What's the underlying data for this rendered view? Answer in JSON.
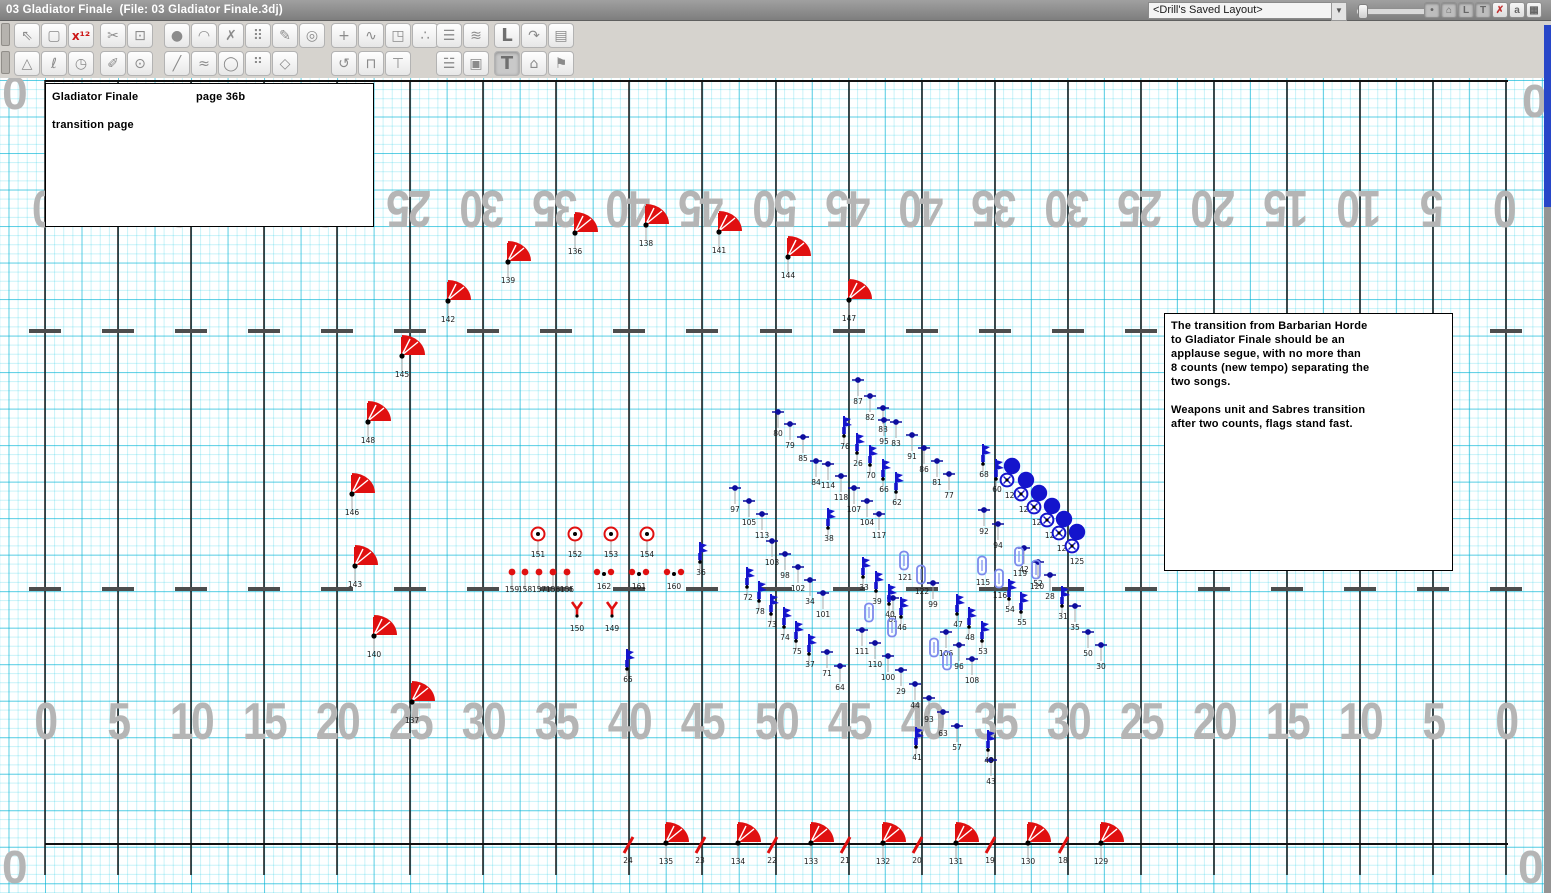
{
  "titlebar": {
    "title": "03 Gladiator Finale  (File: 03 Gladiator Finale.3dj)",
    "layout_selector": "<Drill's Saved Layout>",
    "dropdown_arrow": "▼"
  },
  "titlebar_buttons": [
    {
      "name": "dot-view-button",
      "glyph": "•",
      "pressed": true
    },
    {
      "name": "home-view-button",
      "glyph": "⌂",
      "pressed": true
    },
    {
      "name": "l-view-button",
      "glyph": "L",
      "pressed": true
    },
    {
      "name": "t-view-button",
      "glyph": "T",
      "pressed": true
    },
    {
      "name": "close-button",
      "glyph": "✗",
      "pressed": false,
      "red": true
    },
    {
      "name": "zoom-tool-button",
      "glyph": "a",
      "pressed": false
    },
    {
      "name": "grid-view-button",
      "glyph": "▦",
      "pressed": false
    }
  ],
  "toolbar": {
    "row1_groups": [
      {
        "left": 14,
        "buttons": [
          {
            "name": "select-tool",
            "glyph": "⇖"
          },
          {
            "name": "marquee-select-tool",
            "glyph": "▢"
          },
          {
            "name": "count-x12-tool",
            "glyph": "x¹²",
            "red": true
          }
        ]
      },
      {
        "left": 100,
        "buttons": [
          {
            "name": "cut-tool",
            "glyph": "✂"
          },
          {
            "name": "segment-node-tool",
            "glyph": "⊡"
          }
        ]
      },
      {
        "left": 164,
        "buttons": [
          {
            "name": "dot-tool",
            "glyph": "●"
          },
          {
            "name": "arc-tool",
            "glyph": "◠"
          },
          {
            "name": "curve-tool",
            "glyph": "✗"
          },
          {
            "name": "block-grid-tool",
            "glyph": "⠿"
          },
          {
            "name": "pencil-tool",
            "glyph": "✎"
          },
          {
            "name": "spiral-tool",
            "glyph": "◎"
          }
        ]
      },
      {
        "left": 331,
        "buttons": [
          {
            "name": "move-tool",
            "glyph": "+"
          },
          {
            "name": "path-adjust-tool",
            "glyph": "∿"
          },
          {
            "name": "scale-tool",
            "glyph": "◳"
          },
          {
            "name": "scatter-tool",
            "glyph": "∴"
          }
        ]
      },
      {
        "left": 436,
        "buttons": [
          {
            "name": "align-lines-tool",
            "glyph": "☰"
          },
          {
            "name": "ripple-tool",
            "glyph": "≋"
          }
        ]
      },
      {
        "left": 494,
        "buttons": [
          {
            "name": "ell-maneuver-tool",
            "glyph": "L",
            "big": true
          },
          {
            "name": "follow-arrow-tool",
            "glyph": "↷"
          },
          {
            "name": "notes-sheet-tool",
            "glyph": "▤"
          }
        ]
      }
    ],
    "row2_groups": [
      {
        "left": 14,
        "buttons": [
          {
            "name": "cone-tool",
            "glyph": "△"
          },
          {
            "name": "lasso-tool",
            "glyph": "ℓ"
          },
          {
            "name": "history-clock-tool",
            "glyph": "◷"
          }
        ]
      },
      {
        "left": 100,
        "buttons": [
          {
            "name": "highlighter-tool",
            "glyph": "✐"
          },
          {
            "name": "location-pin-tool",
            "glyph": "⊙"
          }
        ]
      },
      {
        "left": 164,
        "buttons": [
          {
            "name": "line-tool",
            "glyph": "╱"
          },
          {
            "name": "freeform-wave-tool",
            "glyph": "≈"
          },
          {
            "name": "circle-tool",
            "glyph": "◯"
          },
          {
            "name": "dot-cluster-tool",
            "glyph": "⠛"
          },
          {
            "name": "polygon-tool",
            "glyph": "◇"
          }
        ]
      },
      {
        "left": 331,
        "buttons": [
          {
            "name": "rotate-tool",
            "glyph": "↺"
          },
          {
            "name": "gate-turn-tool",
            "glyph": "⊓"
          },
          {
            "name": "pole-tool",
            "glyph": "⊤"
          }
        ]
      },
      {
        "left": 436,
        "buttons": [
          {
            "name": "distribute-tool",
            "glyph": "☱"
          },
          {
            "name": "duplicate-tool",
            "glyph": "▣"
          }
        ]
      },
      {
        "left": 494,
        "buttons": [
          {
            "name": "text-tool",
            "glyph": "T",
            "big": true,
            "pressed": true
          },
          {
            "name": "home-view-tool",
            "glyph": "⌂"
          },
          {
            "name": "flag-marker-tool",
            "glyph": "⚑"
          }
        ]
      }
    ]
  },
  "notes": {
    "box1": {
      "title": "Gladiator Finale",
      "page": "page 36b",
      "subtitle": "transition page"
    },
    "box2_text": "The transition from Barbarian Horde\nto Gladiator Finale should be an\napplause segue, with no more than\n8 counts (new tempo) separating the\ntwo songs.\n\nWeapons unit and Sabres transition\nafter two counts, flags stand fast."
  },
  "field": {
    "yard_numbers": [
      "0",
      "5",
      "10",
      "15",
      "20",
      "25",
      "30",
      "35",
      "40",
      "45",
      "50",
      "45",
      "40",
      "35",
      "30",
      "25",
      "20",
      "15",
      "10",
      "5",
      "0"
    ],
    "corner_zero": "0",
    "left_x": 45,
    "line_spacing": 73.05,
    "top_y": 80,
    "bottom_y": 843,
    "hash_rows": [
      329,
      587
    ],
    "colors": {
      "red": "#e01010",
      "blue": "#1414cc",
      "navy": "#0d0d9e",
      "light_blue": "#7d8aec",
      "number_gray": "#b5b5b5",
      "grid_cyan": "#9adfee",
      "stem_gray": "#a8a8a8"
    }
  },
  "performers": {
    "red_flags": [
      [
        575,
        233,
        "136"
      ],
      [
        646,
        225,
        "138"
      ],
      [
        719,
        232,
        "141"
      ],
      [
        788,
        257,
        "144"
      ],
      [
        849,
        300,
        "147"
      ],
      [
        508,
        262,
        "139"
      ],
      [
        448,
        301,
        "142"
      ],
      [
        402,
        356,
        "145"
      ],
      [
        368,
        422,
        "148"
      ],
      [
        352,
        494,
        "146"
      ],
      [
        355,
        566,
        "143"
      ],
      [
        374,
        636,
        "140"
      ],
      [
        412,
        702,
        "137"
      ],
      [
        666,
        843,
        "135"
      ],
      [
        738,
        843,
        "134"
      ],
      [
        811,
        843,
        "133"
      ],
      [
        883,
        843,
        "132"
      ],
      [
        956,
        843,
        "131"
      ],
      [
        1028,
        843,
        "130"
      ],
      [
        1101,
        843,
        "129"
      ]
    ],
    "red_slashes": [
      [
        628,
        845,
        "24"
      ],
      [
        700,
        845,
        "23"
      ],
      [
        772,
        845,
        "22"
      ],
      [
        845,
        845,
        "21"
      ],
      [
        917,
        845,
        "20"
      ],
      [
        990,
        845,
        "19"
      ],
      [
        1063,
        845,
        "18"
      ]
    ],
    "red_circle_dots": [
      [
        538,
        534,
        "151"
      ],
      [
        575,
        534,
        "152"
      ],
      [
        611,
        534,
        "153"
      ],
      [
        647,
        534,
        "154"
      ]
    ],
    "red_dots": [
      [
        512,
        572,
        "159"
      ],
      [
        525,
        572,
        "158"
      ],
      [
        539,
        572,
        "157"
      ],
      [
        553,
        572,
        "156"
      ],
      [
        567,
        572,
        "155"
      ]
    ],
    "red_tridots": [
      [
        604,
        571,
        "162"
      ],
      [
        639,
        571,
        "161"
      ],
      [
        674,
        571,
        "160"
      ]
    ],
    "red_ys": [
      [
        577,
        611,
        "150"
      ],
      [
        612,
        611,
        "149"
      ]
    ],
    "blue_dots": [
      [
        858,
        380,
        "87"
      ],
      [
        870,
        396,
        "82"
      ],
      [
        883,
        408,
        "88"
      ],
      [
        884,
        420,
        "95"
      ],
      [
        896,
        422,
        "83"
      ],
      [
        778,
        412,
        "80"
      ],
      [
        790,
        424,
        "79"
      ],
      [
        803,
        437,
        "85"
      ],
      [
        816,
        461,
        "84"
      ],
      [
        828,
        464,
        "114"
      ],
      [
        841,
        476,
        "118"
      ],
      [
        735,
        488,
        "97"
      ],
      [
        749,
        501,
        "105"
      ],
      [
        762,
        514,
        "113"
      ],
      [
        854,
        488,
        "107"
      ],
      [
        867,
        501,
        "104"
      ],
      [
        879,
        514,
        "117"
      ],
      [
        984,
        510,
        "92"
      ],
      [
        998,
        524,
        "94"
      ],
      [
        1024,
        548,
        "42"
      ],
      [
        1038,
        562,
        "52"
      ],
      [
        1050,
        575,
        "28"
      ],
      [
        772,
        541,
        "103"
      ],
      [
        785,
        554,
        "98"
      ],
      [
        798,
        567,
        "102"
      ],
      [
        810,
        580,
        "34"
      ],
      [
        823,
        593,
        "101"
      ],
      [
        862,
        630,
        "111"
      ],
      [
        875,
        643,
        "110"
      ],
      [
        888,
        656,
        "100"
      ],
      [
        901,
        670,
        "29"
      ],
      [
        915,
        684,
        "44"
      ],
      [
        929,
        698,
        "93"
      ],
      [
        943,
        712,
        "63"
      ],
      [
        957,
        726,
        "57"
      ],
      [
        991,
        760,
        "43"
      ],
      [
        933,
        583,
        "99"
      ],
      [
        893,
        598,
        "61"
      ],
      [
        946,
        632,
        "106"
      ],
      [
        959,
        645,
        "96"
      ],
      [
        972,
        659,
        "108"
      ],
      [
        827,
        652,
        "71"
      ],
      [
        840,
        666,
        "64"
      ],
      [
        912,
        435,
        "91"
      ],
      [
        924,
        448,
        "86"
      ],
      [
        937,
        461,
        "81"
      ],
      [
        949,
        474,
        "77"
      ],
      [
        1088,
        632,
        "50"
      ],
      [
        1101,
        645,
        "30"
      ],
      [
        1075,
        606,
        "35"
      ]
    ],
    "blue_figures": [
      [
        845,
        427,
        "76"
      ],
      [
        858,
        444,
        "26"
      ],
      [
        871,
        456,
        "70"
      ],
      [
        884,
        470,
        "66"
      ],
      [
        897,
        483,
        "62"
      ],
      [
        829,
        519,
        "38"
      ],
      [
        701,
        553,
        "36"
      ],
      [
        984,
        455,
        "68"
      ],
      [
        997,
        470,
        "60"
      ],
      [
        1063,
        597,
        "31"
      ],
      [
        748,
        578,
        "72"
      ],
      [
        760,
        592,
        "78"
      ],
      [
        772,
        605,
        "73"
      ],
      [
        785,
        618,
        "74"
      ],
      [
        797,
        632,
        "75"
      ],
      [
        810,
        645,
        "37"
      ],
      [
        864,
        568,
        "33"
      ],
      [
        877,
        582,
        "39"
      ],
      [
        890,
        595,
        "40"
      ],
      [
        902,
        608,
        "46"
      ],
      [
        958,
        605,
        "47"
      ],
      [
        970,
        618,
        "48"
      ],
      [
        983,
        632,
        "53"
      ],
      [
        917,
        738,
        "41"
      ],
      [
        989,
        741,
        "49"
      ],
      [
        628,
        660,
        "65"
      ],
      [
        1010,
        590,
        "54"
      ],
      [
        1022,
        603,
        "55"
      ]
    ],
    "blue_outlines": [
      [
        905,
        560,
        "121"
      ],
      [
        922,
        574,
        "122"
      ],
      [
        983,
        565,
        "115"
      ],
      [
        1000,
        578,
        "116"
      ],
      [
        1020,
        556,
        "119"
      ],
      [
        1037,
        569,
        "120"
      ],
      [
        870,
        612,
        ""
      ],
      [
        935,
        647,
        ""
      ],
      [
        948,
        660,
        ""
      ],
      [
        893,
        627,
        ""
      ]
    ],
    "sabres": [
      [
        1012,
        466,
        "128"
      ],
      [
        1026,
        480,
        "124"
      ],
      [
        1039,
        493,
        "127"
      ],
      [
        1052,
        506,
        "126"
      ],
      [
        1064,
        519,
        "123"
      ],
      [
        1077,
        532,
        "125"
      ]
    ]
  }
}
